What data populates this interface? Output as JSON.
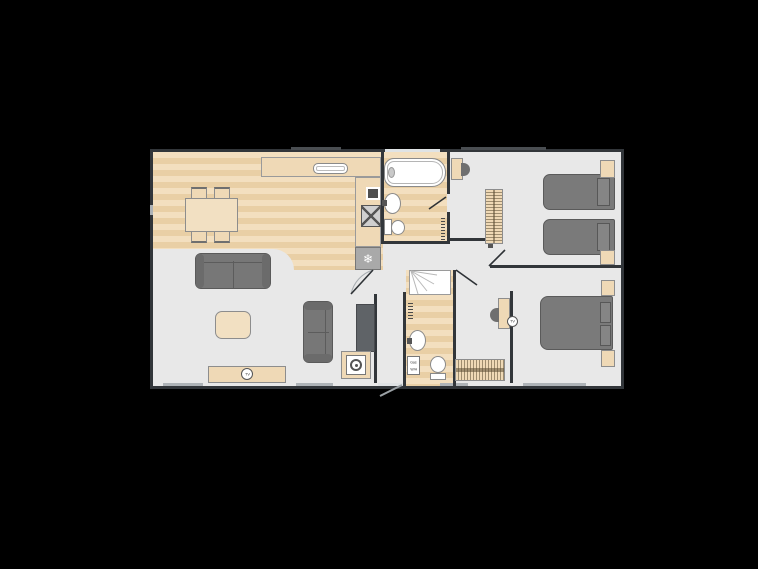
{
  "page": {
    "background": "#000000",
    "type": "lodge-floor-plan"
  },
  "palette": {
    "wall": "#32363a",
    "floor_gray": "#e8e8e8",
    "wood": "#eed4ac",
    "wood_stripe": "#e9cfa5",
    "furniture_tan": "#efd9b6",
    "upholstery_gray": "#7a7a7a",
    "fixture_white": "#ffffff",
    "appliance_gray": "#a9a9a9",
    "window": "#aeb3b7"
  },
  "labels": {
    "tv_living": "TV",
    "tv_master": "TV",
    "water_heater_line1": "Gas",
    "water_heater_line2": "W/H"
  },
  "icons": {
    "fridge_freezer_glyph": "❄"
  },
  "rooms": [
    {
      "name": "open-plan-lounge"
    },
    {
      "name": "dining-kitchen"
    },
    {
      "name": "family-bathroom"
    },
    {
      "name": "twin-bedroom"
    },
    {
      "name": "master-bedroom"
    },
    {
      "name": "en-suite-shower-room"
    },
    {
      "name": "hallway"
    },
    {
      "name": "entrance-lobby"
    }
  ],
  "furniture": [
    "dining-table",
    "dining-chair",
    "dining-chair",
    "dining-chair",
    "dining-chair",
    "kitchen-worktop",
    "sink",
    "microwave",
    "hob",
    "fridge-freezer",
    "bath",
    "washbasin",
    "toilet",
    "towel-rail",
    "shelf-unit",
    "wardrobe",
    "single-bed",
    "single-bed",
    "bedside-table",
    "bedside-table",
    "double-bed",
    "bedside-table",
    "bedside-table",
    "dressing-table",
    "stool",
    "tv-point",
    "wardrobe",
    "sofa-large",
    "coffee-table",
    "sofa-small",
    "side-unit",
    "washing-machine",
    "tv-unit",
    "shower-cubicle",
    "washbasin",
    "toilet",
    "towel-rail",
    "gas-water-heater",
    "entrance-door"
  ]
}
